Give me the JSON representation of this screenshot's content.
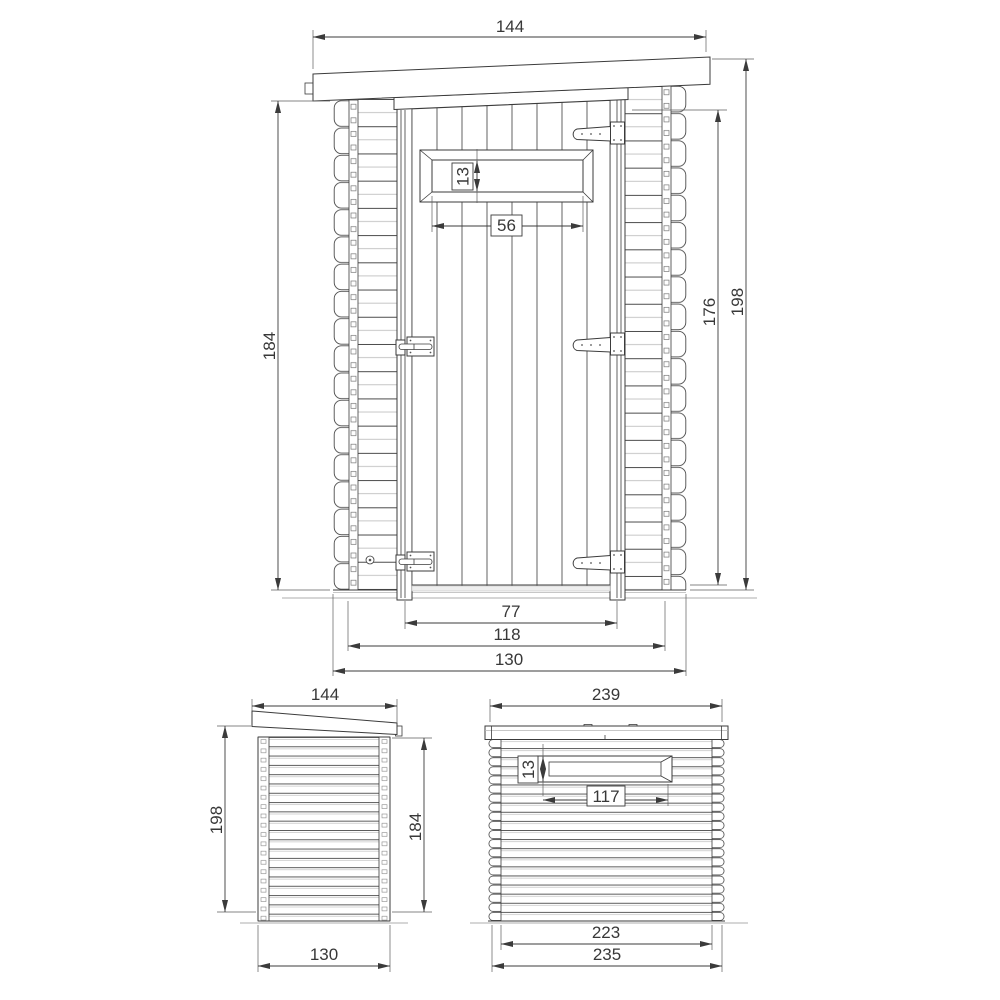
{
  "colors": {
    "background": "#ffffff",
    "line_dark": "#3b3b3b",
    "line_light": "#b5b5b5",
    "dimension_text": "#383838"
  },
  "views": {
    "front": {
      "roof_width": "144",
      "left_height": "184",
      "opening_height": "176",
      "overall_height": "198",
      "window_height": "13",
      "window_width": "56",
      "door_width": "77",
      "frame_width": "118",
      "wall_width": "130"
    },
    "side": {
      "roof_depth": "144",
      "front_height": "198",
      "rear_height": "184",
      "floor_depth": "130"
    },
    "rear": {
      "roof_width": "239",
      "window_height": "13",
      "window_width": "117",
      "inner_width": "223",
      "overall_width": "235"
    }
  }
}
